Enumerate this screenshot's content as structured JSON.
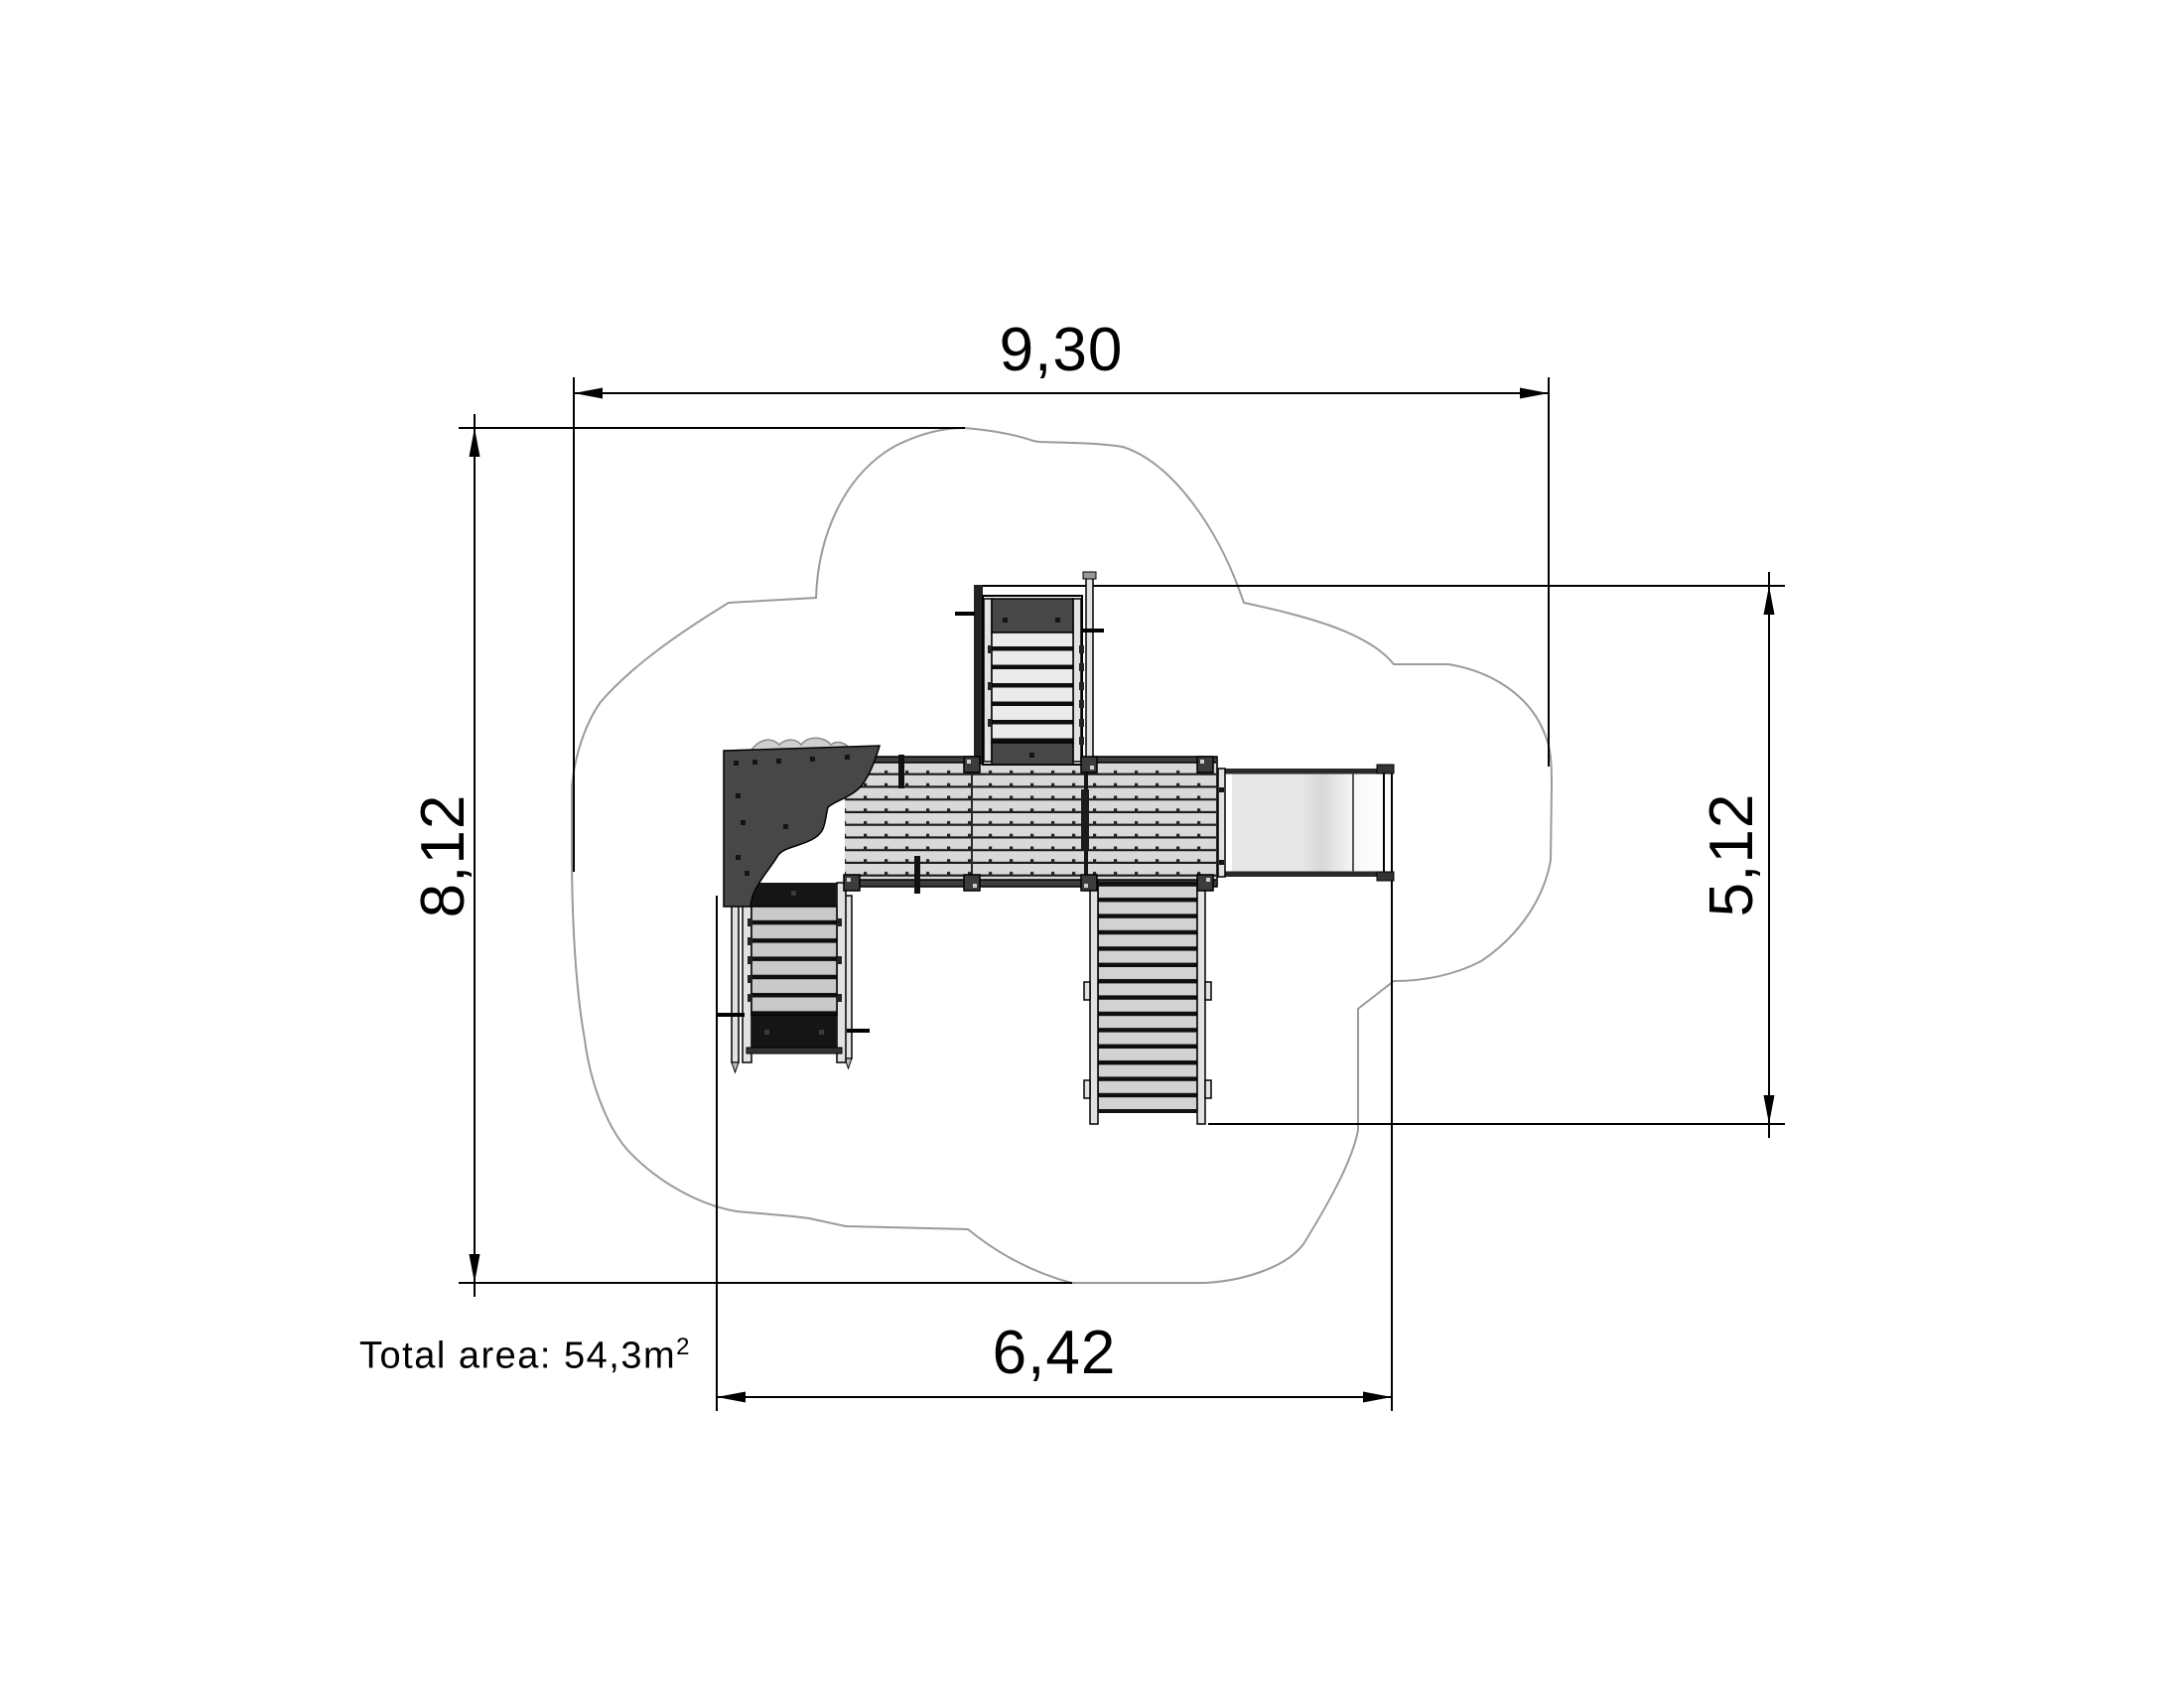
{
  "drawing": {
    "dimensions": {
      "top_width": "9,30",
      "left_height": "8,12",
      "right_height": "5,12",
      "bottom_width": "6,42"
    },
    "annotation": {
      "total_area_text": "Total area: 54,3m",
      "total_area_exponent": "2"
    }
  },
  "colors": {
    "background": "#ffffff",
    "line": "#000000",
    "cloud_stroke": "#9b9b9b",
    "dark_gray": "#474747",
    "near_black": "#151515",
    "rail_light": "#e2e2e2",
    "deck_board": "#d9d9d9",
    "deck_line": "#1a1a1a",
    "tower_slat": "#ebebeb",
    "module_slat": "#c9c9c9",
    "tread": "#d2d2d2",
    "slide_light": "#e7e7e7",
    "slide_mid": "#d8d8d8",
    "bump_gray": "#cfcfcf"
  }
}
